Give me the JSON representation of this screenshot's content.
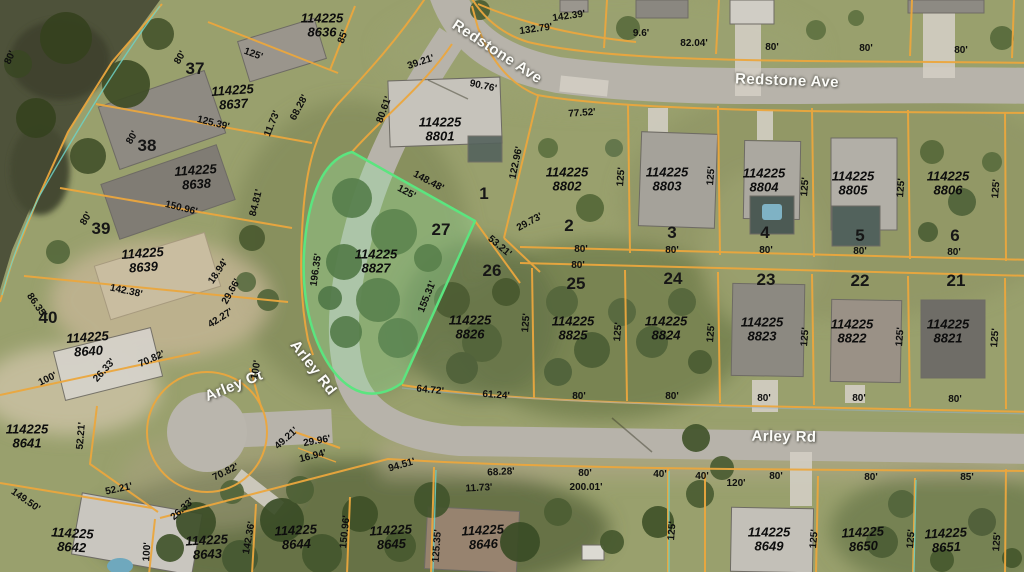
{
  "map_colors": {
    "parcel_line": "#eba73e",
    "highlight_stroke": "#5be57f",
    "highlight_fill": "rgba(150,240,165,0.30)",
    "secondary_line": "#6ed2c6",
    "street_label": "#fcfcf8",
    "dimension_text": "#0f0f0f"
  },
  "streets": [
    {
      "name": "Redstone Ave"
    },
    {
      "name": "Arley Ct"
    },
    {
      "name": "Arley Rd"
    }
  ],
  "highlighted_parcel": {
    "id": "114225 8827",
    "lot": "27"
  },
  "labels": [
    {
      "t": "114225\n8636",
      "x": 322,
      "y": 25,
      "r": 0,
      "c": "pid"
    },
    {
      "t": "114225\n8637",
      "x": 233,
      "y": 97,
      "r": -4,
      "c": "pid"
    },
    {
      "t": "114225\n8638",
      "x": 196,
      "y": 177,
      "r": -4,
      "c": "pid"
    },
    {
      "t": "114225\n8639",
      "x": 143,
      "y": 260,
      "r": -4,
      "c": "pid"
    },
    {
      "t": "114225\n8640",
      "x": 88,
      "y": 344,
      "r": -4,
      "c": "pid"
    },
    {
      "t": "114225\n8641",
      "x": 27,
      "y": 436,
      "r": 0,
      "c": "pid"
    },
    {
      "t": "114225\n8642",
      "x": 72,
      "y": 540,
      "r": 3,
      "c": "pid"
    },
    {
      "t": "114225\n8643",
      "x": 207,
      "y": 547,
      "r": -3,
      "c": "pid"
    },
    {
      "t": "114225\n8644",
      "x": 296,
      "y": 537,
      "r": -3,
      "c": "pid"
    },
    {
      "t": "114225\n8645",
      "x": 391,
      "y": 537,
      "r": -3,
      "c": "pid"
    },
    {
      "t": "114225\n8646",
      "x": 483,
      "y": 537,
      "r": -3,
      "c": "pid"
    },
    {
      "t": "114225\n8649",
      "x": 769,
      "y": 539,
      "r": 0,
      "c": "pid"
    },
    {
      "t": "114225\n8650",
      "x": 863,
      "y": 539,
      "r": -3,
      "c": "pid"
    },
    {
      "t": "114225\n8651",
      "x": 946,
      "y": 540,
      "r": -3,
      "c": "pid"
    },
    {
      "t": "114225\n8801",
      "x": 440,
      "y": 129,
      "r": 0,
      "c": "pid"
    },
    {
      "t": "114225\n8802",
      "x": 567,
      "y": 179,
      "r": 0,
      "c": "pid"
    },
    {
      "t": "114225\n8803",
      "x": 667,
      "y": 179,
      "r": 0,
      "c": "pid"
    },
    {
      "t": "114225\n8804",
      "x": 764,
      "y": 180,
      "r": 0,
      "c": "pid"
    },
    {
      "t": "114225\n8805",
      "x": 853,
      "y": 183,
      "r": 0,
      "c": "pid"
    },
    {
      "t": "114225\n8806",
      "x": 948,
      "y": 183,
      "r": 0,
      "c": "pid"
    },
    {
      "t": "114225\n8821",
      "x": 948,
      "y": 331,
      "r": 0,
      "c": "pid"
    },
    {
      "t": "114225\n8822",
      "x": 852,
      "y": 331,
      "r": 0,
      "c": "pid"
    },
    {
      "t": "114225\n8823",
      "x": 762,
      "y": 329,
      "r": 0,
      "c": "pid"
    },
    {
      "t": "114225\n8824",
      "x": 666,
      "y": 328,
      "r": 0,
      "c": "pid"
    },
    {
      "t": "114225\n8825",
      "x": 573,
      "y": 328,
      "r": 0,
      "c": "pid"
    },
    {
      "t": "114225\n8826",
      "x": 470,
      "y": 327,
      "r": 0,
      "c": "pid"
    },
    {
      "t": "114225\n8827",
      "x": 376,
      "y": 261,
      "r": 0,
      "c": "pid"
    },
    {
      "t": "37",
      "x": 195,
      "y": 69,
      "r": 0,
      "c": "lot"
    },
    {
      "t": "38",
      "x": 147,
      "y": 146,
      "r": 0,
      "c": "lot"
    },
    {
      "t": "39",
      "x": 101,
      "y": 229,
      "r": 0,
      "c": "lot"
    },
    {
      "t": "40",
      "x": 48,
      "y": 318,
      "r": 0,
      "c": "lot"
    },
    {
      "t": "1",
      "x": 484,
      "y": 194,
      "r": 0,
      "c": "lot"
    },
    {
      "t": "2",
      "x": 569,
      "y": 226,
      "r": 0,
      "c": "lot"
    },
    {
      "t": "3",
      "x": 672,
      "y": 233,
      "r": 0,
      "c": "lot"
    },
    {
      "t": "4",
      "x": 765,
      "y": 233,
      "r": 0,
      "c": "lot"
    },
    {
      "t": "5",
      "x": 860,
      "y": 236,
      "r": 0,
      "c": "lot"
    },
    {
      "t": "6",
      "x": 955,
      "y": 236,
      "r": 0,
      "c": "lot"
    },
    {
      "t": "27",
      "x": 441,
      "y": 230,
      "r": 0,
      "c": "lot"
    },
    {
      "t": "26",
      "x": 492,
      "y": 271,
      "r": 0,
      "c": "lot"
    },
    {
      "t": "25",
      "x": 576,
      "y": 284,
      "r": 0,
      "c": "lot"
    },
    {
      "t": "24",
      "x": 673,
      "y": 279,
      "r": 0,
      "c": "lot"
    },
    {
      "t": "23",
      "x": 766,
      "y": 280,
      "r": 0,
      "c": "lot"
    },
    {
      "t": "22",
      "x": 860,
      "y": 281,
      "r": 0,
      "c": "lot"
    },
    {
      "t": "21",
      "x": 956,
      "y": 281,
      "r": 0,
      "c": "lot"
    },
    {
      "t": "Redstone Ave",
      "x": 497,
      "y": 52,
      "r": 33,
      "c": "street"
    },
    {
      "t": "Redstone Ave",
      "x": 787,
      "y": 81,
      "r": 2,
      "c": "street"
    },
    {
      "t": "Arley Ct",
      "x": 234,
      "y": 386,
      "r": -22,
      "c": "street"
    },
    {
      "t": "Arley Rd",
      "x": 313,
      "y": 368,
      "r": 52,
      "c": "street"
    },
    {
      "t": "Arley Rd",
      "x": 784,
      "y": 437,
      "r": 1,
      "c": "street"
    },
    {
      "t": "142.39'",
      "x": 569,
      "y": 17,
      "r": -8,
      "c": "dim"
    },
    {
      "t": "132.79'",
      "x": 536,
      "y": 30,
      "r": -8,
      "c": "dim"
    },
    {
      "t": "9.6'",
      "x": 641,
      "y": 34,
      "r": 0,
      "c": "dim"
    },
    {
      "t": "82.04'",
      "x": 694,
      "y": 44,
      "r": 0,
      "c": "dim"
    },
    {
      "t": "80'",
      "x": 772,
      "y": 48,
      "r": 0,
      "c": "dim"
    },
    {
      "t": "80'",
      "x": 866,
      "y": 49,
      "r": 0,
      "c": "dim"
    },
    {
      "t": "80'",
      "x": 961,
      "y": 51,
      "r": 0,
      "c": "dim"
    },
    {
      "t": "39.21'",
      "x": 421,
      "y": 63,
      "r": -18,
      "c": "dim"
    },
    {
      "t": "90.76'",
      "x": 483,
      "y": 87,
      "r": 12,
      "c": "dim"
    },
    {
      "t": "80.61'",
      "x": 385,
      "y": 110,
      "r": -70,
      "c": "dim"
    },
    {
      "t": "68.28'",
      "x": 300,
      "y": 108,
      "r": -62,
      "c": "dim"
    },
    {
      "t": "11.73'",
      "x": 273,
      "y": 124,
      "r": -68,
      "c": "dim"
    },
    {
      "t": "125.39'",
      "x": 213,
      "y": 124,
      "r": 14,
      "c": "dim"
    },
    {
      "t": "85'",
      "x": 344,
      "y": 37,
      "r": -70,
      "c": "dim"
    },
    {
      "t": "125'",
      "x": 253,
      "y": 55,
      "r": 20,
      "c": "dim"
    },
    {
      "t": "80'",
      "x": 181,
      "y": 58,
      "r": -60,
      "c": "dim"
    },
    {
      "t": "80'",
      "x": 11,
      "y": 58,
      "r": -65,
      "c": "dim"
    },
    {
      "t": "122.96'",
      "x": 517,
      "y": 163,
      "r": -78,
      "c": "dim"
    },
    {
      "t": "148.48'",
      "x": 428,
      "y": 182,
      "r": 28,
      "c": "dim"
    },
    {
      "t": "125'",
      "x": 406,
      "y": 193,
      "r": 28,
      "c": "dim"
    },
    {
      "t": "77.52'",
      "x": 582,
      "y": 114,
      "r": -4,
      "c": "dim"
    },
    {
      "t": "80'",
      "x": 581,
      "y": 250,
      "r": 0,
      "c": "dim"
    },
    {
      "t": "80'",
      "x": 672,
      "y": 251,
      "r": 0,
      "c": "dim"
    },
    {
      "t": "80'",
      "x": 766,
      "y": 251,
      "r": 0,
      "c": "dim"
    },
    {
      "t": "80'",
      "x": 860,
      "y": 252,
      "r": 0,
      "c": "dim"
    },
    {
      "t": "80'",
      "x": 954,
      "y": 253,
      "r": 0,
      "c": "dim"
    },
    {
      "t": "80'",
      "x": 578,
      "y": 266,
      "r": 0,
      "c": "dim"
    },
    {
      "t": "125'",
      "x": 622,
      "y": 177,
      "r": -85,
      "c": "dim"
    },
    {
      "t": "125'",
      "x": 712,
      "y": 176,
      "r": -85,
      "c": "dim"
    },
    {
      "t": "125'",
      "x": 806,
      "y": 187,
      "r": -85,
      "c": "dim"
    },
    {
      "t": "125'",
      "x": 902,
      "y": 188,
      "r": -85,
      "c": "dim"
    },
    {
      "t": "125'",
      "x": 997,
      "y": 189,
      "r": -85,
      "c": "dim"
    },
    {
      "t": "29.73'",
      "x": 530,
      "y": 223,
      "r": -28,
      "c": "dim"
    },
    {
      "t": "53.21'",
      "x": 499,
      "y": 247,
      "r": 40,
      "c": "dim"
    },
    {
      "t": "155.31'",
      "x": 428,
      "y": 297,
      "r": -68,
      "c": "dim"
    },
    {
      "t": "196.35'",
      "x": 317,
      "y": 270,
      "r": -82,
      "c": "dim"
    },
    {
      "t": "125'",
      "x": 527,
      "y": 323,
      "r": -85,
      "c": "dim"
    },
    {
      "t": "125'",
      "x": 619,
      "y": 332,
      "r": -85,
      "c": "dim"
    },
    {
      "t": "125'",
      "x": 712,
      "y": 333,
      "r": -85,
      "c": "dim"
    },
    {
      "t": "125'",
      "x": 806,
      "y": 337,
      "r": -85,
      "c": "dim"
    },
    {
      "t": "125'",
      "x": 901,
      "y": 337,
      "r": -85,
      "c": "dim"
    },
    {
      "t": "125'",
      "x": 996,
      "y": 338,
      "r": -85,
      "c": "dim"
    },
    {
      "t": "80'",
      "x": 579,
      "y": 397,
      "r": 0,
      "c": "dim"
    },
    {
      "t": "80'",
      "x": 672,
      "y": 397,
      "r": 0,
      "c": "dim"
    },
    {
      "t": "80'",
      "x": 764,
      "y": 399,
      "r": 0,
      "c": "dim"
    },
    {
      "t": "80'",
      "x": 859,
      "y": 399,
      "r": 0,
      "c": "dim"
    },
    {
      "t": "80'",
      "x": 955,
      "y": 400,
      "r": 0,
      "c": "dim"
    },
    {
      "t": "64.72'",
      "x": 430,
      "y": 391,
      "r": 6,
      "c": "dim"
    },
    {
      "t": "61.24'",
      "x": 496,
      "y": 396,
      "r": 4,
      "c": "dim"
    },
    {
      "t": "120'",
      "x": 736,
      "y": 484,
      "r": 0,
      "c": "dim"
    },
    {
      "t": "80'",
      "x": 776,
      "y": 477,
      "r": 0,
      "c": "dim"
    },
    {
      "t": "80'",
      "x": 871,
      "y": 478,
      "r": 0,
      "c": "dim"
    },
    {
      "t": "85'",
      "x": 967,
      "y": 478,
      "r": 0,
      "c": "dim"
    },
    {
      "t": "40'",
      "x": 660,
      "y": 475,
      "r": 0,
      "c": "dim"
    },
    {
      "t": "40'",
      "x": 702,
      "y": 477,
      "r": 0,
      "c": "dim"
    },
    {
      "t": "125'",
      "x": 815,
      "y": 539,
      "r": -85,
      "c": "dim"
    },
    {
      "t": "125'",
      "x": 912,
      "y": 539,
      "r": -85,
      "c": "dim"
    },
    {
      "t": "125'",
      "x": 998,
      "y": 542,
      "r": -85,
      "c": "dim"
    },
    {
      "t": "125'",
      "x": 673,
      "y": 531,
      "r": -85,
      "c": "dim"
    },
    {
      "t": "125.35'",
      "x": 438,
      "y": 546,
      "r": -86,
      "c": "dim"
    },
    {
      "t": "142.36'",
      "x": 250,
      "y": 538,
      "r": -80,
      "c": "dim"
    },
    {
      "t": "150.96'",
      "x": 346,
      "y": 532,
      "r": -84,
      "c": "dim"
    },
    {
      "t": "100'",
      "x": 148,
      "y": 552,
      "r": -86,
      "c": "dim"
    },
    {
      "t": "68.28'",
      "x": 501,
      "y": 473,
      "r": -3,
      "c": "dim"
    },
    {
      "t": "11.73'",
      "x": 479,
      "y": 489,
      "r": -3,
      "c": "dim"
    },
    {
      "t": "80'",
      "x": 585,
      "y": 474,
      "r": 0,
      "c": "dim"
    },
    {
      "t": "200.01'",
      "x": 586,
      "y": 488,
      "r": 0,
      "c": "dim"
    },
    {
      "t": "94.51'",
      "x": 402,
      "y": 466,
      "r": -16,
      "c": "dim"
    },
    {
      "t": "70.82'",
      "x": 226,
      "y": 473,
      "r": -26,
      "c": "dim"
    },
    {
      "t": "26.33'",
      "x": 183,
      "y": 510,
      "r": -42,
      "c": "dim"
    },
    {
      "t": "29.96'",
      "x": 317,
      "y": 442,
      "r": -10,
      "c": "dim"
    },
    {
      "t": "16.94'",
      "x": 313,
      "y": 457,
      "r": -14,
      "c": "dim"
    },
    {
      "t": "49.21'",
      "x": 287,
      "y": 439,
      "r": -42,
      "c": "dim"
    },
    {
      "t": "52.21'",
      "x": 82,
      "y": 436,
      "r": -85,
      "c": "dim"
    },
    {
      "t": "52.21'",
      "x": 119,
      "y": 490,
      "r": -12,
      "c": "dim"
    },
    {
      "t": "149.50'",
      "x": 25,
      "y": 501,
      "r": 35,
      "c": "dim"
    },
    {
      "t": "100'",
      "x": 257,
      "y": 370,
      "r": -80,
      "c": "dim"
    },
    {
      "t": "100'",
      "x": 48,
      "y": 380,
      "r": -26,
      "c": "dim"
    },
    {
      "t": "42.27'",
      "x": 221,
      "y": 319,
      "r": -32,
      "c": "dim"
    },
    {
      "t": "70.82'",
      "x": 152,
      "y": 360,
      "r": -24,
      "c": "dim"
    },
    {
      "t": "26.33'",
      "x": 105,
      "y": 371,
      "r": -48,
      "c": "dim"
    },
    {
      "t": "86.35'",
      "x": 36,
      "y": 306,
      "r": 55,
      "c": "dim"
    },
    {
      "t": "142.38'",
      "x": 126,
      "y": 292,
      "r": 12,
      "c": "dim"
    },
    {
      "t": "18.94'",
      "x": 219,
      "y": 272,
      "r": -56,
      "c": "dim"
    },
    {
      "t": "29.66'",
      "x": 232,
      "y": 292,
      "r": -60,
      "c": "dim"
    },
    {
      "t": "84.81'",
      "x": 257,
      "y": 203,
      "r": -76,
      "c": "dim"
    },
    {
      "t": "150.96'",
      "x": 181,
      "y": 209,
      "r": 14,
      "c": "dim"
    },
    {
      "t": "80'",
      "x": 87,
      "y": 219,
      "r": -60,
      "c": "dim"
    },
    {
      "t": "80'",
      "x": 133,
      "y": 138,
      "r": -60,
      "c": "dim"
    }
  ]
}
